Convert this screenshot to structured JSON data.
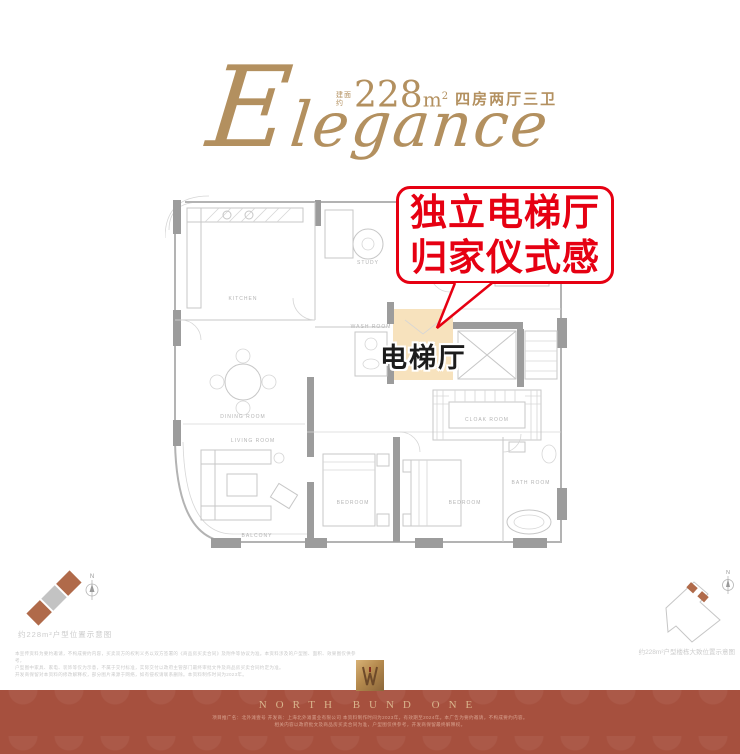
{
  "colors": {
    "accent_red": "#e60012",
    "gold": "#b3905f",
    "beige": "#f7e2bd",
    "band": "#a6503e",
    "brown": "#b06a4a"
  },
  "header": {
    "script": "Elegance",
    "area_prefix_top": "建面",
    "area_prefix_bottom": "约",
    "area_value": "228",
    "area_unit": "m",
    "area_sup": "2",
    "layout_text": "四房两厅三卫"
  },
  "callout": {
    "line1": "独立电梯厅",
    "line2": "归家仪式感"
  },
  "floorplan": {
    "highlight_label": "电梯厅",
    "highlight_color": "#f7e2bd",
    "room_labels": [
      {
        "t": "KITCHEN",
        "x": 78,
        "y": 108
      },
      {
        "t": "STUDY",
        "x": 203,
        "y": 72
      },
      {
        "t": "BEDROOM",
        "x": 334,
        "y": 74
      },
      {
        "t": "DINING ROOM",
        "x": 78,
        "y": 226
      },
      {
        "t": "LIVING ROOM",
        "x": 88,
        "y": 250
      },
      {
        "t": "WASH ROOM",
        "x": 206,
        "y": 136
      },
      {
        "t": "BALCONY",
        "x": 92,
        "y": 345
      },
      {
        "t": "BEDROOM",
        "x": 188,
        "y": 312
      },
      {
        "t": "BEDROOM",
        "x": 300,
        "y": 312
      },
      {
        "t": "CLOAK ROOM",
        "x": 322,
        "y": 229
      },
      {
        "t": "BATH ROOM",
        "x": 366,
        "y": 292
      }
    ]
  },
  "compass": {
    "n": "N"
  },
  "legend_left": {
    "caption": "约228m²户型位置示意图"
  },
  "legend_right": {
    "caption": "约228m²户型楼栋大致位置示意图"
  },
  "disclaimer": {
    "lines": [
      "本宣传资料为要约邀请，不构成要约内容，买卖双方的权利义务以双方签署的《商品房买卖合同》及附件等协议为准。本资料涉及的户型图、面积、效果图仅供参考，",
      "户型图中家具、家电、装饰等仅为示意，不属于交付标准，实际交付以政府主管部门最终审批文件及商品房买卖合同约定为准。",
      "开发商保留对本资料的修改解释权，部分图片来源于网络，如有侵权请联系删除。本资料制作时间为2023年。"
    ]
  },
  "footer": {
    "brand": "NORTH BUND ONE",
    "notes": [
      "项目推广名：北外滩壹号 开发商：上海北外滩置业有限公司 本资料制作时间为2023年，有效期至2024年。本广告为要约邀请，不构成要约内容。",
      "相关内容以政府批文及商品房买卖合同为准，户型图仅供参考，开发商保留最终解释权。"
    ]
  }
}
